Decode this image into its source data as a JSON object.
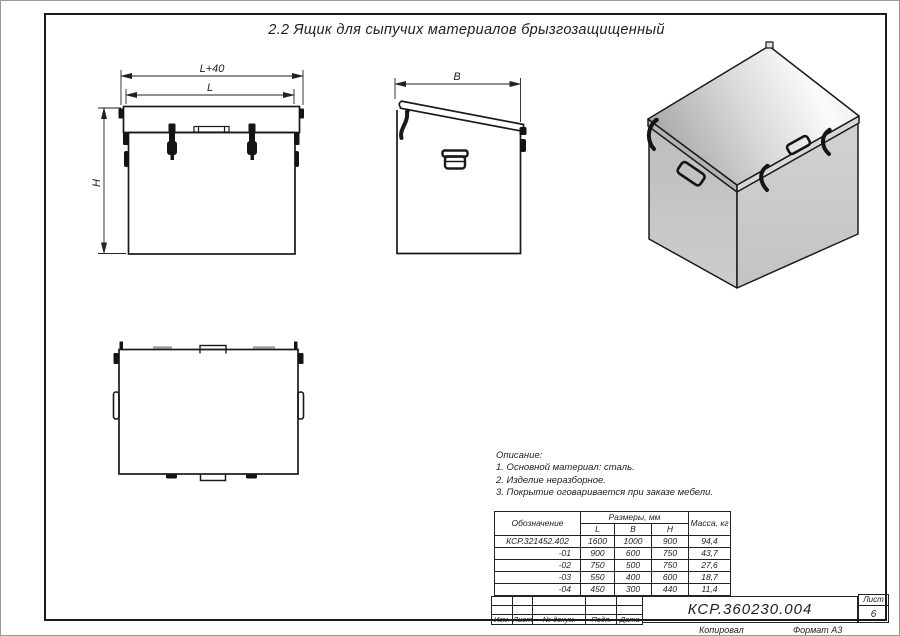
{
  "title": "2.2 Ящик для сыпучих материалов брызгозащищенный",
  "views": {
    "front": {
      "dim_outer": "L+40",
      "dim_inner": "L",
      "dim_height": "H"
    },
    "side": {
      "dim_width": "B"
    }
  },
  "description": {
    "heading": "Описание:",
    "lines": [
      "1. Основной материал: сталь.",
      "2. Изделие неразборное.",
      "3. Покрытие оговаривается при заказе мебели."
    ]
  },
  "dim_table": {
    "col_designation": "Обозначение",
    "col_sizes": "Размеры, мм",
    "col_l": "L",
    "col_b": "B",
    "col_h": "H",
    "col_mass": "Масса, кг",
    "rows": [
      {
        "designation": "КСР.321452.402",
        "l": "1600",
        "b": "1000",
        "h": "900",
        "mass": "94,4"
      },
      {
        "designation": "-01",
        "l": "900",
        "b": "600",
        "h": "750",
        "mass": "43,7"
      },
      {
        "designation": "-02",
        "l": "750",
        "b": "500",
        "h": "750",
        "mass": "27,6"
      },
      {
        "designation": "-03",
        "l": "550",
        "b": "400",
        "h": "600",
        "mass": "18,7"
      },
      {
        "designation": "-04",
        "l": "450",
        "b": "300",
        "h": "440",
        "mass": "11,4"
      }
    ]
  },
  "title_block": {
    "doc_number": "КСР.360230.004",
    "sheet_label": "Лист",
    "sheet_number": "6",
    "col_izm": "Изм.",
    "col_list": "Лист",
    "col_doc": "№ докум.",
    "col_podp": "Подп.",
    "col_data": "Дата",
    "footer_left": "Копировал",
    "footer_right": "Формат А3"
  },
  "colors": {
    "line": "#1a1a1a",
    "metal_light": "#f5f5f5",
    "metal_mid": "#c7c7c7",
    "metal_dark": "#a8a8a8"
  }
}
